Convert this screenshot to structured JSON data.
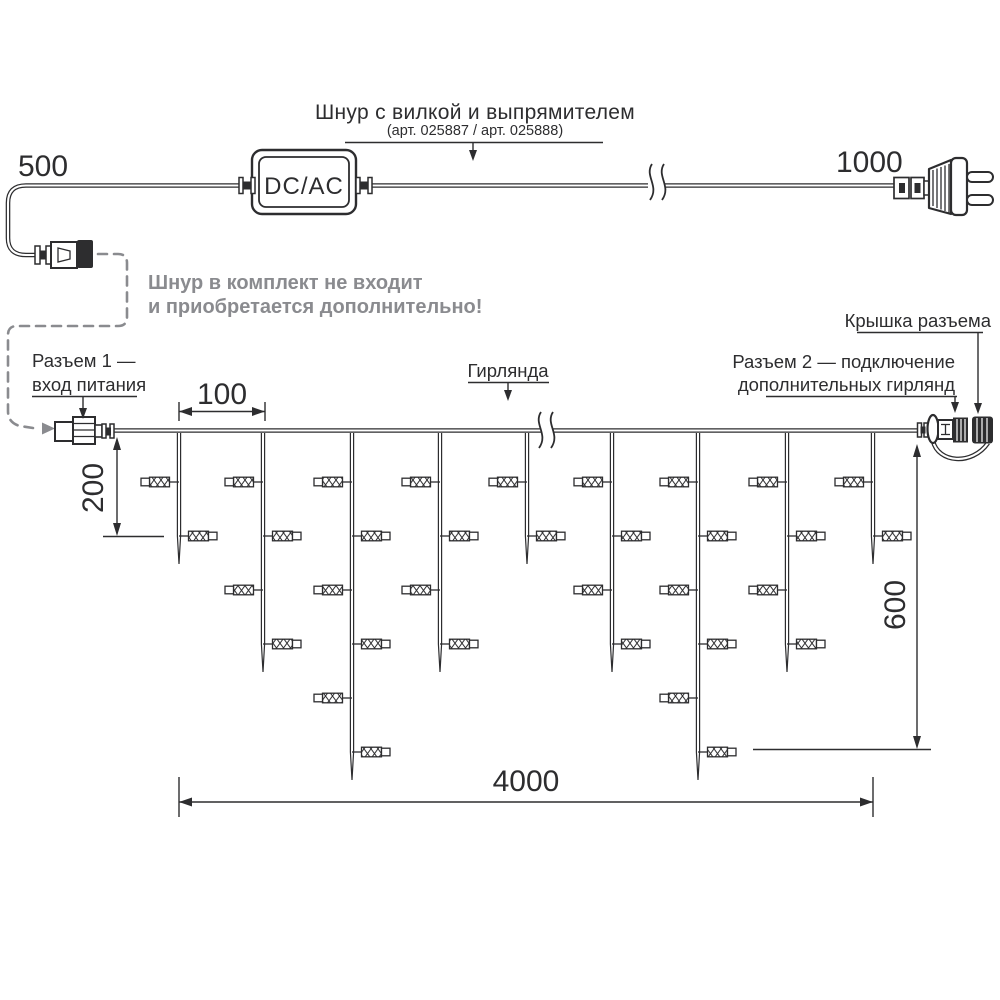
{
  "colors": {
    "ink": "#2d2d2f",
    "gray": "#8a8b8f",
    "background": "#ffffff"
  },
  "cord_section": {
    "title": "Шнур с вилкой и выпрямителем",
    "subtitle": "(арт. 025887 / арт. 025888)",
    "length_left": "500",
    "length_right": "1000",
    "box_label": "DC/AC",
    "note": {
      "line1": "Шнур в комплект не входит",
      "line2": "и приобретается дополнительно!"
    }
  },
  "garland_section": {
    "label": "Гирлянда",
    "connector1": {
      "line1": "Разъем 1 —",
      "line2": "вход питания"
    },
    "connector2": {
      "line1": "Разъем 2 — подключение",
      "line2": "дополнительных гирлянд"
    },
    "cap_label": "Крышка разъема",
    "dim_spacing": "100",
    "dim_short_drop": "200",
    "dim_long_drop": "600",
    "dim_total_length": "4000"
  },
  "garland": {
    "wire_y": 430,
    "drop_top_y": 433,
    "drop_xs": [
      179,
      263,
      352,
      440,
      527,
      612,
      698,
      787,
      873
    ],
    "lights_per_drop": [
      2,
      4,
      6,
      4,
      2,
      4,
      6,
      4,
      2
    ],
    "first_row_y": 482,
    "row_spacing": 54,
    "tip_extra": 28,
    "light": {
      "wire_len": 9.5,
      "body_w": 20,
      "body_h": 9.6,
      "cap_w": 8.5,
      "cap_h": 7.6
    }
  }
}
